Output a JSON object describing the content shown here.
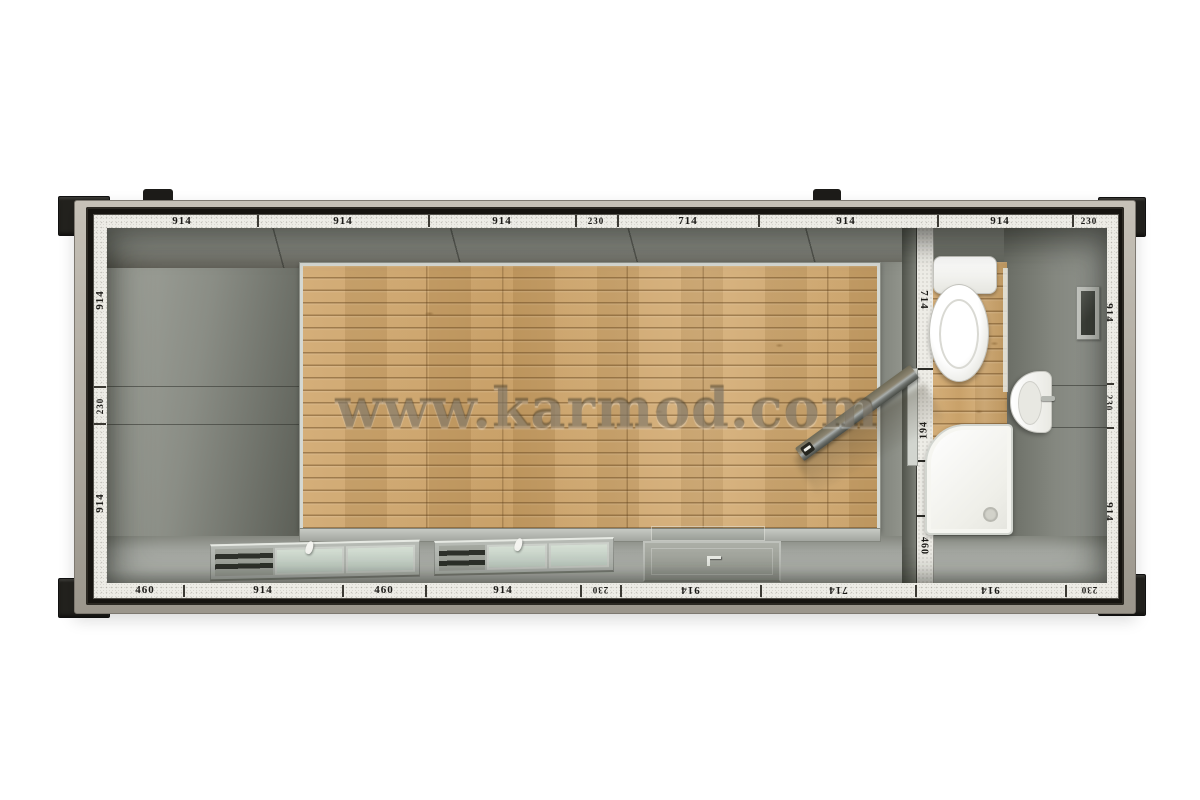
{
  "watermark": {
    "text": "www.karmod.com"
  },
  "dimension_labels": {
    "top": [
      "914",
      "914",
      "914",
      "230",
      "714",
      "914",
      "914",
      "230"
    ],
    "bottom": [
      "460",
      "914",
      "460",
      "914",
      "230",
      "914",
      "714",
      "914",
      "230"
    ],
    "left": [
      "914",
      "230",
      "914"
    ],
    "right": [
      "914",
      "230",
      "914"
    ],
    "partition": [
      "714",
      "194",
      "460"
    ]
  },
  "colors": {
    "background": "#ffffff",
    "outer_band": "#b1aca2",
    "frame": "#161410",
    "dimension_strip": "#edece6",
    "wall_gray": "#8a8d85",
    "floor_gray": "#a8aba5",
    "wood_floor": "#cba269",
    "window_glass": "#c8d5ca",
    "fixture_white": "#ffffff"
  }
}
